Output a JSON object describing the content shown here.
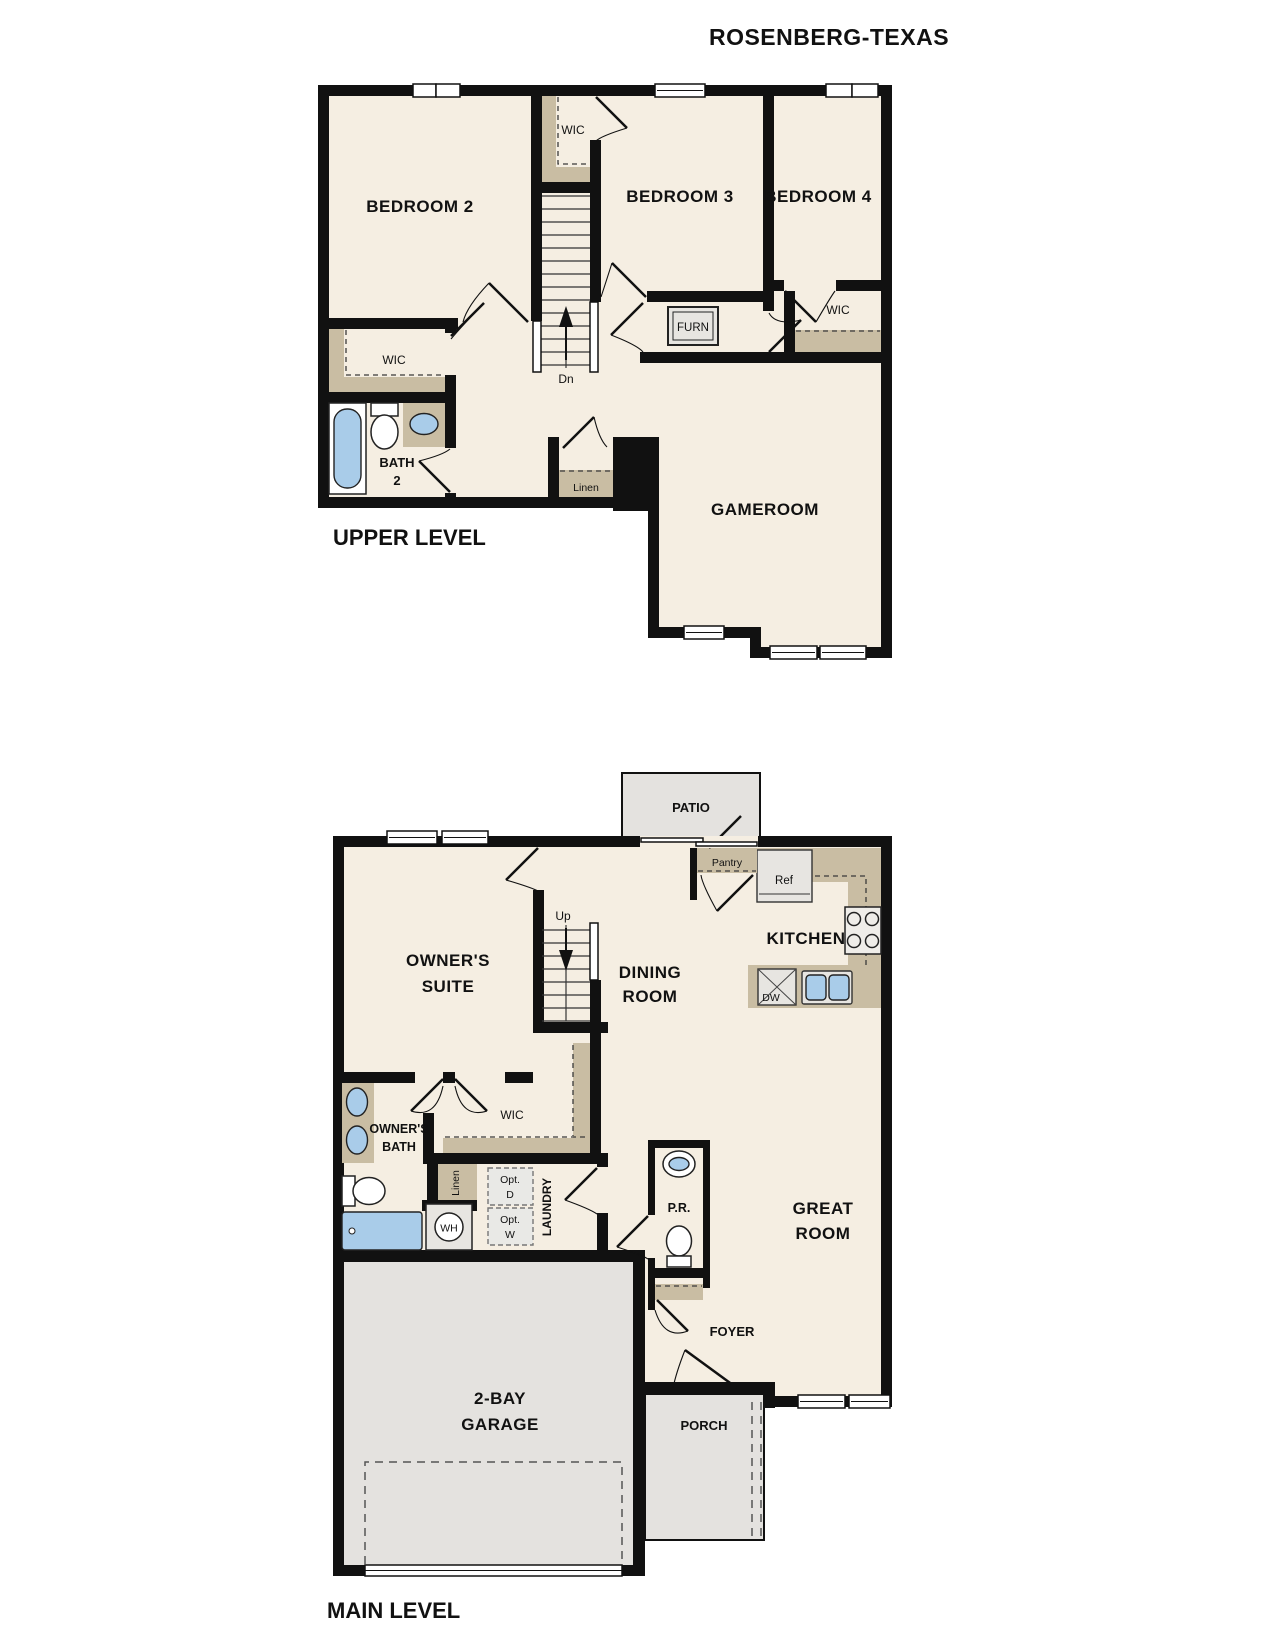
{
  "title": "ROSENBERG-TEXAS",
  "upper": {
    "level_label": "UPPER LEVEL",
    "bedroom2": "BEDROOM 2",
    "bedroom3": "BEDROOM 3",
    "bedroom4": "BEDROOM 4",
    "gameroom": "GAMEROOM",
    "bath": {
      "l1": "BATH",
      "l2": "2"
    },
    "wic_b2": "WIC",
    "wic_b3": "WIC",
    "wic_b4": "WIC",
    "furn": "FURN",
    "linen": "Linen",
    "stair": "Dn"
  },
  "main": {
    "level_label": "MAIN LEVEL",
    "owners_suite": {
      "l1": "OWNER'S",
      "l2": "SUITE"
    },
    "dining": {
      "l1": "DINING",
      "l2": "ROOM"
    },
    "kitchen": "KITCHEN",
    "great_room": {
      "l1": "GREAT",
      "l2": "ROOM"
    },
    "patio": "PATIO",
    "porch": "PORCH",
    "foyer": "FOYER",
    "pantry": "Pantry",
    "ref": "Ref",
    "dw": "DW",
    "wh": "WH",
    "owners_bath": {
      "l1": "OWNER'S",
      "l2": "BATH"
    },
    "wic": "WIC",
    "linen": "Linen",
    "laundry": "LAUNDRY",
    "pr": "P.R.",
    "opt_d": {
      "l1": "Opt.",
      "l2": "D"
    },
    "opt_w": {
      "l1": "Opt.",
      "l2": "W"
    },
    "garage": {
      "l1": "2-BAY",
      "l2": "GARAGE"
    },
    "stair": "Up"
  },
  "colors": {
    "floor_beige": "#f5eee2",
    "wall_black": "#111111",
    "closet_shelf_tan": "#c9bda3",
    "concrete_gray": "#e4e2df",
    "fixture_blue": "#a9cce9"
  }
}
